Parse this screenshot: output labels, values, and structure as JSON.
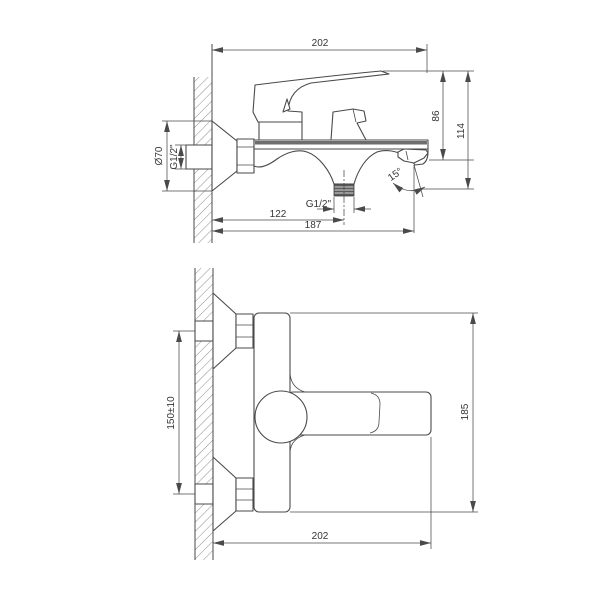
{
  "canvas": {
    "background": "#ffffff",
    "line_color": "#4a4a4a"
  },
  "side_view": {
    "dim_overall_width": "202",
    "dim_handle_to_spout_height": "86",
    "dim_overall_height": "114",
    "dim_flange_diameter": "Ø70",
    "dim_wall_inlet_thread": "G1/2\"",
    "dim_shower_outlet_thread": "G1/2\"",
    "dim_wall_to_shower_outlet": "122",
    "dim_wall_to_spout_tip": "187",
    "dim_spout_angle": "15°"
  },
  "front_view": {
    "dim_inlet_centers_spacing": "150±10",
    "dim_overall_height": "185",
    "dim_overall_width": "202"
  }
}
